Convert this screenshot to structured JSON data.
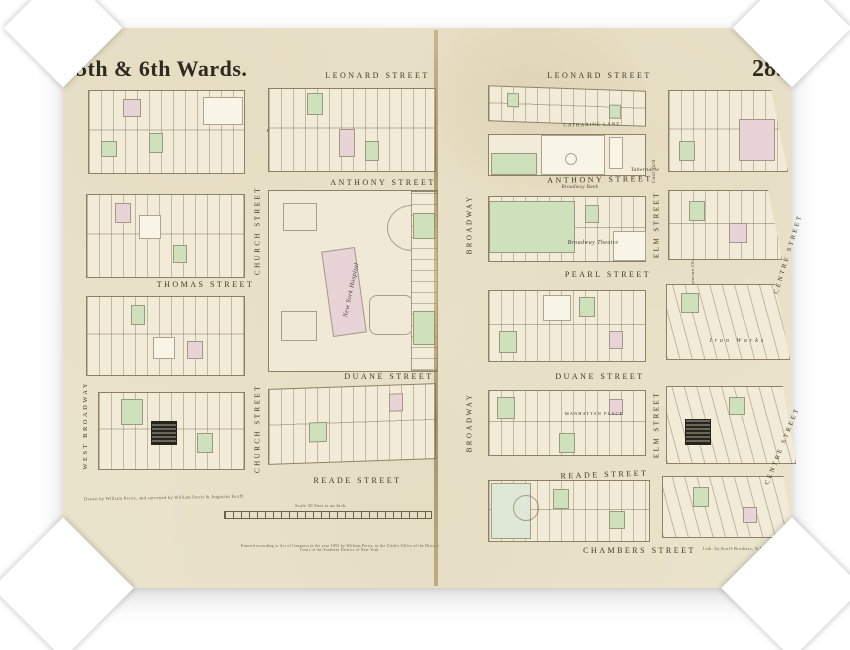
{
  "sheet": {
    "title": "5th & 6th Wards.",
    "plate_number": "28.",
    "paper_color": "#eae3cb"
  },
  "streets": {
    "leonard": "LEONARD STREET",
    "anthony": "ANTHONY STREET",
    "thomas": "THOMAS STREET",
    "duane": "DUANE STREET",
    "reade": "READE STREET",
    "chambers": "CHAMBERS STREET",
    "pearl": "PEARL STREET",
    "catharine": "CATHARINE LANE",
    "manhattan": "MANHATTAN PLACE",
    "broadway": "BROADWAY",
    "church": "CHURCH STREET",
    "elm": "ELM STREET",
    "centre": "CENTRE STREET",
    "west_broadway": "WEST BROADWAY"
  },
  "buildings": {
    "hospital": "New York Hospital",
    "tabernacle": "Tabernacle",
    "broadway_bank": "Broadway Bank",
    "coal_yard": "Coal Yard",
    "broadway_theatre": "Broadway Theatre",
    "presbyterian": "Presbyterian Church",
    "episcopal": "Episcopal Church",
    "iron_works": "Iron  Works"
  },
  "notes": {
    "scale_label": "Scale 50 Feet to an Inch.",
    "surveyor_credit": "Drawn by William Perris, and surveyed by William Perris & Augustus Korff.",
    "lith_credit": "Lith. by Korff Brothers, N.Y.",
    "copyright_line": "Entered according to Act of Congress in the year 1852 by William Perris, in the Clerk's Office of the District Court of the Southern District of New York."
  },
  "colors": {
    "parcel_green": "#cfe0bd",
    "parcel_pink": "#e8d4d7",
    "line": "#8d8166",
    "ink": "#3f3827"
  }
}
